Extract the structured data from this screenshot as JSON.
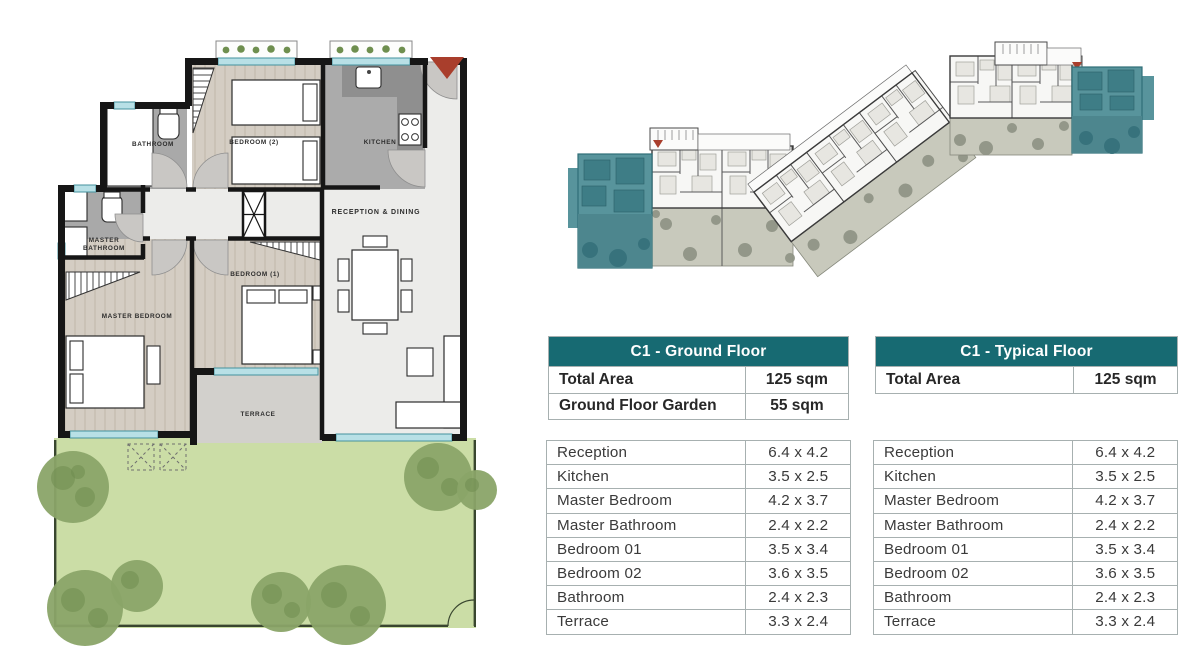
{
  "colors": {
    "header_teal": "#176a72",
    "highlight_teal": "#58949c",
    "accent_red": "#a93e2c",
    "garden_green": "#cbdda6"
  },
  "floor_plan": {
    "labels": {
      "bathroom": "BATHROOM",
      "bedroom2": "BEDROOM (2)",
      "kitchen": "KITCHEN",
      "reception_dining": "RECEPTION & DINING",
      "master_bath_1": "MASTER",
      "master_bath_2": "BATHROOM",
      "master_bedroom": "MASTER BEDROOM",
      "bedroom1": "BEDROOM (1)",
      "terrace": "TERRACE"
    }
  },
  "tables": {
    "ground": {
      "title": "C1 - Ground Floor",
      "summary": [
        {
          "label": "Total Area",
          "value": "125 sqm"
        },
        {
          "label": "Ground Floor Garden",
          "value": "55  sqm"
        }
      ],
      "rooms": [
        {
          "label": "Reception",
          "value": "6.4 x 4.2"
        },
        {
          "label": "Kitchen",
          "value": "3.5 x 2.5"
        },
        {
          "label": "Master Bedroom",
          "value": "4.2 x 3.7"
        },
        {
          "label": "Master Bathroom",
          "value": "2.4 x 2.2"
        },
        {
          "label": "Bedroom 01",
          "value": "3.5 x 3.4"
        },
        {
          "label": "Bedroom 02",
          "value": "3.6 x 3.5"
        },
        {
          "label": "Bathroom",
          "value": "2.4 x 2.3"
        },
        {
          "label": "Terrace",
          "value": "3.3 x 2.4"
        }
      ]
    },
    "typical": {
      "title": "C1 - Typical Floor",
      "summary": [
        {
          "label": "Total Area",
          "value": "125 sqm"
        }
      ],
      "rooms": [
        {
          "label": "Reception",
          "value": "6.4 x 4.2"
        },
        {
          "label": "Kitchen",
          "value": "3.5 x 2.5"
        },
        {
          "label": "Master Bedroom",
          "value": "4.2 x 3.7"
        },
        {
          "label": "Master Bathroom",
          "value": "2.4 x 2.2"
        },
        {
          "label": "Bedroom 01",
          "value": "3.5 x 3.4"
        },
        {
          "label": "Bedroom 02",
          "value": "3.6 x 3.5"
        },
        {
          "label": "Bathroom",
          "value": "2.4 x 2.3"
        },
        {
          "label": "Terrace",
          "value": "3.3 x 2.4"
        }
      ]
    }
  }
}
